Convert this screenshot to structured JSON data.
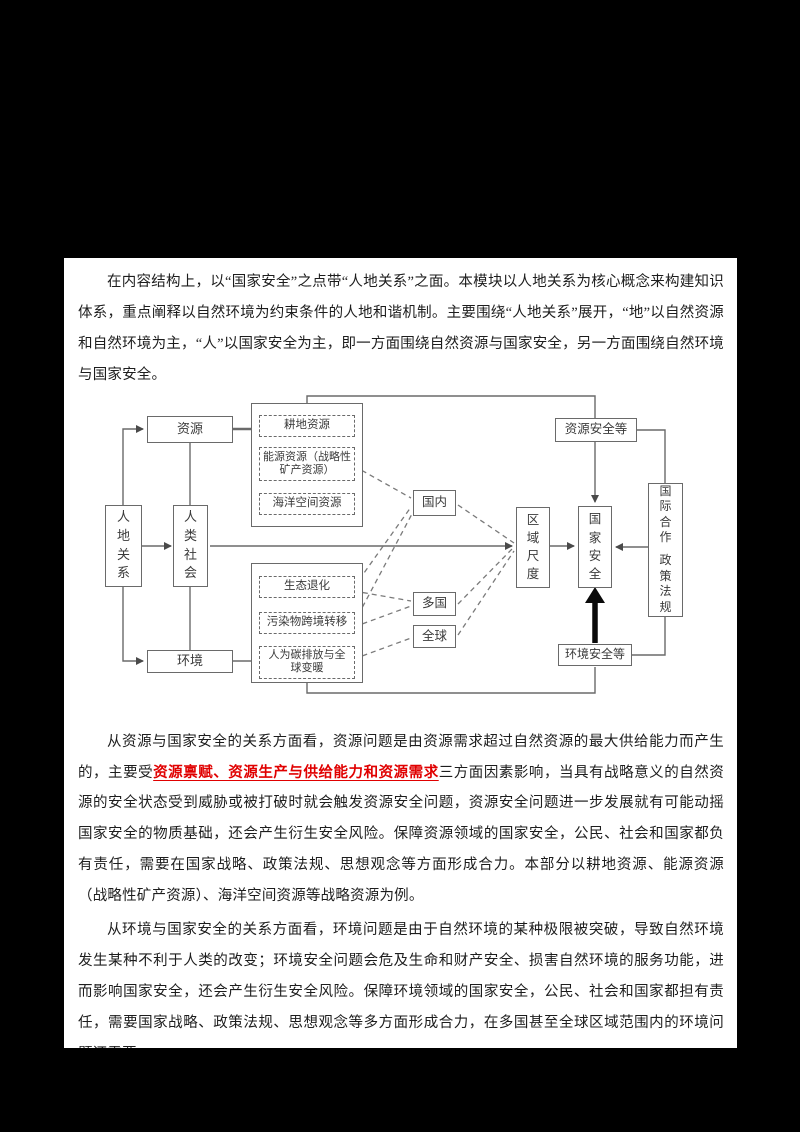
{
  "page": {
    "paragraph1": "在内容结构上，以“国家安全”之点带“人地关系”之面。本模块以人地关系为核心概念来构建知识体系，重点阐释以自然环境为约束条件的人地和谐机制。主要围绕“人地关系”展开，“地”以自然资源和自然环境为主，“人”以国家安全为主，即一方面围绕自然资源与国家安全，另一方面围绕自然环境与国家安全。",
    "paragraph2_before": "从资源与国家安全的关系方面看，资源问题是由资源需求超过自然资源的最大供给能力而产生的，主要受",
    "paragraph2_highlight": "资源禀赋、资源生产与供给能力和资源需求",
    "paragraph2_after": "三方面因素影响，当具有战略意义的自然资源的安全状态受到威胁或被打破时就会触发资源安全问题，资源安全问题进一步发展就有可能动摇国家安全的物质基础，还会产生衍生安全风险。保障资源领域的国家安全，公民、社会和国家都负有责任，需要在国家战略、政策法规、思想观念等方面形成合力。本部分以耕地资源、能源资源（战略性矿产资源）、海洋空间资源等战略资源为例。",
    "paragraph3": "从环境与国家安全的关系方面看，环境问题是由于自然环境的某种极限被突破，导致自然环境发生某种不利于人类的改变；环境安全问题会危及生命和财产安全、损害自然环境的服务功能，进而影响国家安全，还会产生衍生安全风险。保障环境领域的国家安全，公民、社会和国家都担有责任，需要国家战略、政策法规、思想观念等多方面形成合力，在多国甚至全球区域范围内的环境问题还需要"
  },
  "diagram": {
    "human_land": "人地关系",
    "human_society": "人类社会",
    "resources": "资源",
    "environment": "环境",
    "farmland": "耕地资源",
    "energy": "能源资源（战略性矿产资源）",
    "marine": "海洋空间资源",
    "ecological_degradation": "生态退化",
    "pollution_transfer": "污染物跨境转移",
    "carbon_warming": "人为碳排放与全球变暖",
    "domestic": "国内",
    "multi_country": "多国",
    "global": "全球",
    "regional_scale": "区域尺度",
    "national_security": "国家安全",
    "resource_security": "资源安全等",
    "environment_security": "环境安全等",
    "intl_cooperation": "国际合作",
    "policy_regulation": "政策法规"
  },
  "colors": {
    "background": "#000000",
    "page": "#ffffff",
    "highlight_red": "#e00000",
    "diagram_line": "#6a6a6a"
  }
}
